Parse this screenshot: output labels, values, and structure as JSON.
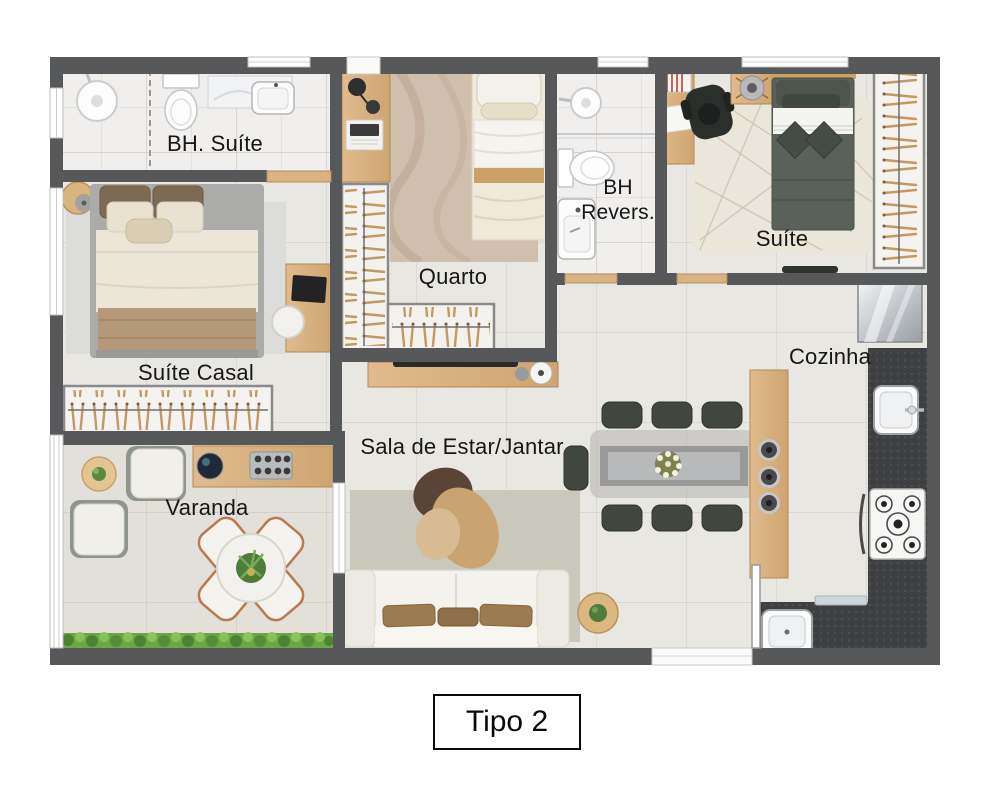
{
  "title_box": {
    "label": "Tipo 2"
  },
  "rooms": {
    "bh_suite": {
      "label": "BH. Suíte"
    },
    "quarto": {
      "label": "Quarto"
    },
    "bh_revers": {
      "label_line1": "BH",
      "label_line2": "Revers."
    },
    "suite": {
      "label": "Suíte"
    },
    "suite_casal": {
      "label": "Suíte Casal"
    },
    "varanda": {
      "label": "Varanda"
    },
    "sala": {
      "label": "Sala de Estar/Jantar"
    },
    "cozinha": {
      "label": "Cozinha"
    }
  },
  "colors": {
    "wall": "#57585a",
    "floor": "#e9e7e2",
    "bathroom_floor": "#f0efed",
    "varanda_floor": "#e3e0da",
    "wood": "#d8b284",
    "hanger_wood": "#c49a63",
    "dark_counter": "#3f4042",
    "suite_bed": "#566056",
    "living_rug": "#c9c8ba",
    "hedge_green": "#6aa844",
    "label_text": "#161616"
  }
}
